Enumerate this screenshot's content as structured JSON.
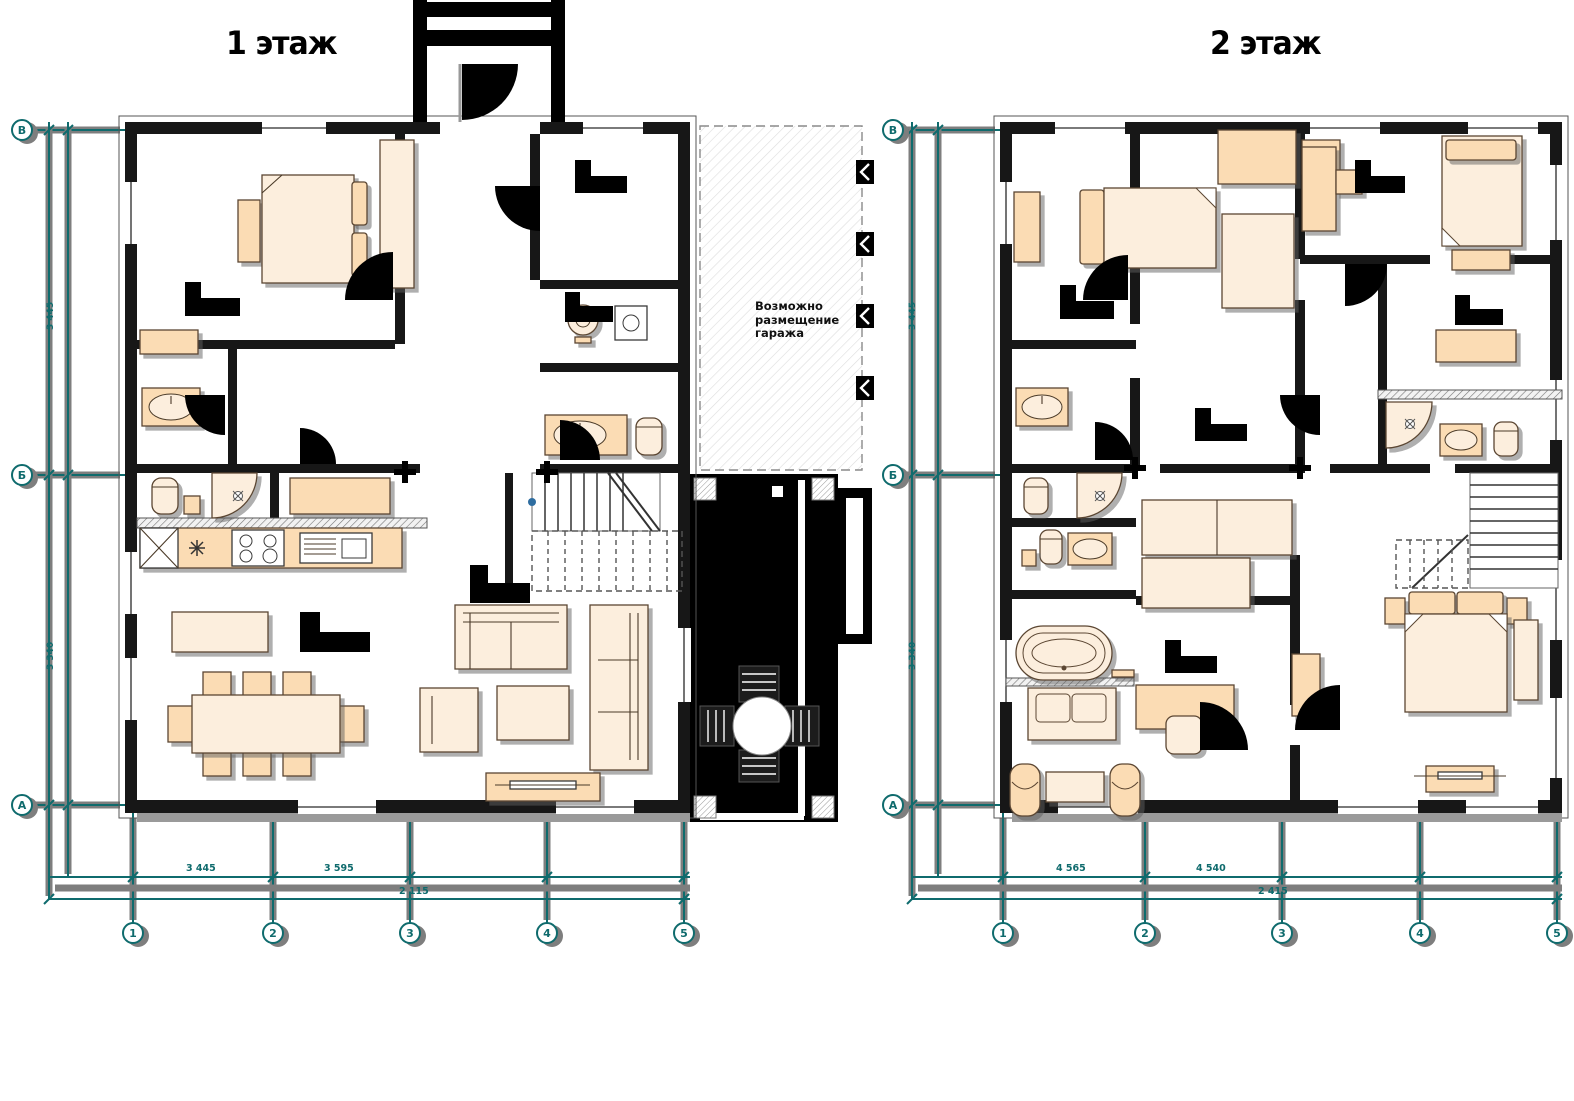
{
  "sheet": {
    "floors": [
      {
        "title": "1 этаж"
      },
      {
        "title": "2 этаж"
      }
    ],
    "garage_note": {
      "lines": [
        "Возможно",
        "размещение",
        "гаража"
      ]
    },
    "axes": {
      "floor1": {
        "columns": [
          "1",
          "2",
          "3",
          "4",
          "5"
        ],
        "rows": [
          "В",
          "Б",
          "А"
        ],
        "bottom_dims": [
          "3 445",
          "3 595",
          "2 115"
        ],
        "side_dims": [
          "3 445",
          "3 340"
        ]
      },
      "floor2": {
        "columns": [
          "1",
          "2",
          "3",
          "4",
          "5"
        ],
        "rows": [
          "В",
          "Б",
          "А"
        ],
        "bottom_dims": [
          "4 565",
          "4 540",
          "2 415"
        ],
        "side_dims": [
          "3 445",
          "3 340"
        ]
      }
    },
    "colors": {
      "axis_teal": "#0f6b6d",
      "furniture_fill": "#fbdcb4",
      "furniture_fill_light": "#fceedd",
      "furniture_outline": "#5b4632",
      "wall": "#171717",
      "shadow_gray": "#7e7e7e",
      "terrace_black": "#060606",
      "hatch_gray": "#8a8a8a"
    }
  }
}
